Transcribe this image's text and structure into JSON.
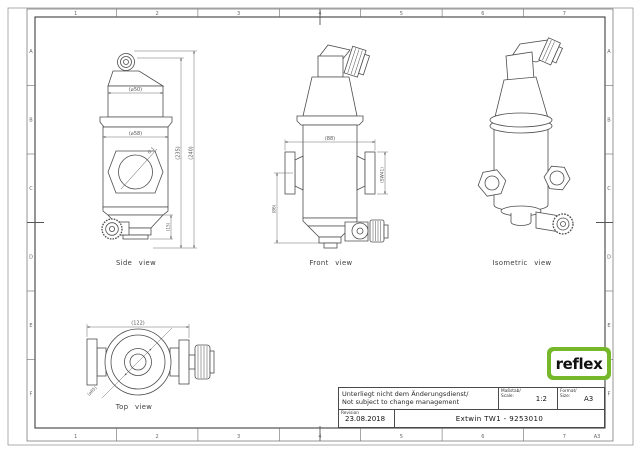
{
  "frame": {
    "columns": [
      "1",
      "2",
      "3",
      "4",
      "5",
      "6",
      "7"
    ],
    "rows": [
      "A",
      "B",
      "C",
      "D",
      "E",
      "F"
    ],
    "corner_format": "A3"
  },
  "logo": {
    "text": "reflex",
    "green": "#76b82a"
  },
  "title_block": {
    "note_line1": "Unterliegt nicht dem Änderungsdienst/",
    "note_line2": "Not subject to change management",
    "scale_label_1": "Maßstab/",
    "scale_label_2": "Scale:",
    "scale_value": "1:2",
    "format_label_1": "Format/",
    "format_label_2": "Size:",
    "format_value": "A3",
    "revision_label": "Revision",
    "revision_date": "23.08.2018",
    "drawing_title": "Extwin TW1 - 9253010"
  },
  "views": {
    "side": {
      "label": "Side view",
      "dims": {
        "d50": "(⌀50)",
        "d58": "(⌀58)",
        "h235": "(235)",
        "h240": "(240)",
        "h15": "(15)",
        "thread": "G 1"
      }
    },
    "front": {
      "label": "Front view",
      "dims": {
        "w88": "(88)",
        "sw41": "(SW41)",
        "h86": "(86)"
      }
    },
    "isometric": {
      "label": "Isometric view"
    },
    "top": {
      "label": "Top view",
      "dims": {
        "w122": "(122)",
        "d65": "(⌀65)"
      }
    }
  }
}
